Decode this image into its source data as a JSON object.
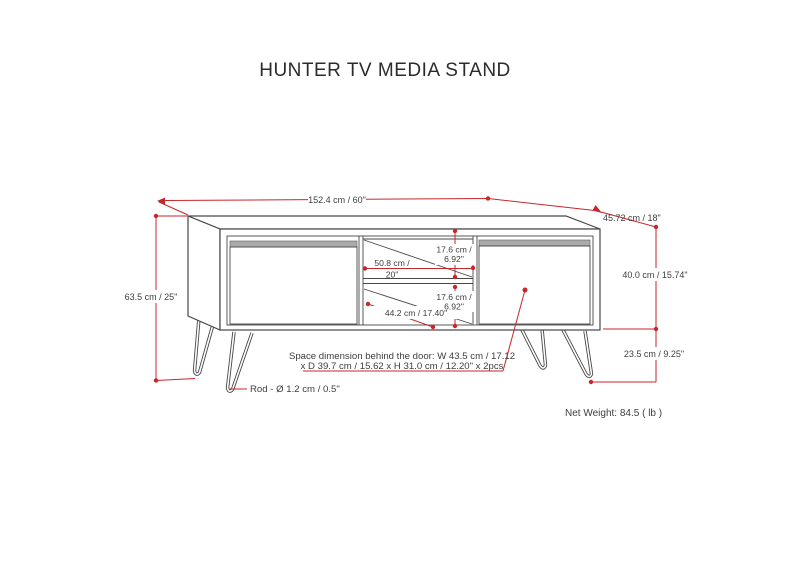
{
  "title": "HUNTER TV MEDIA STAND",
  "dimension_labels": {
    "overall_width": "152.4 cm / 60\"",
    "overall_depth": "45.72 cm / 18\"",
    "overall_height": "63.5 cm / 25\"",
    "cabinet_height": "40.0 cm / 15.74\"",
    "leg_height": "23.5 cm / 9.25\"",
    "upper_opening_height_line1": "17.6 cm /",
    "upper_opening_height_line2": "6.92\"",
    "lower_opening_height_line1": "17.6 cm /",
    "lower_opening_height_line2": "6.92\"",
    "opening_width_line1": "50.8 cm /",
    "opening_width_line2": "20\"",
    "lower_opening_width": "44.2 cm / 17.40\"",
    "rod_diameter": "Rod - Ø 1.2 cm / 0.5\"",
    "door_space_line1": "Space dimension behind the door:  W 43.5 cm / 17.12",
    "door_space_line2": "x D 39.7 cm / 15.62 x H 31.0 cm / 12.20\" x 2pcs",
    "net_weight": "Net Weight: 84.5 ( lb )"
  },
  "colors": {
    "dimension_red": "#c9262c",
    "drawing_line": "#474747",
    "label_text": "#3e3e3e",
    "door_bar_fill": "#ababab",
    "background": "#ffffff"
  }
}
